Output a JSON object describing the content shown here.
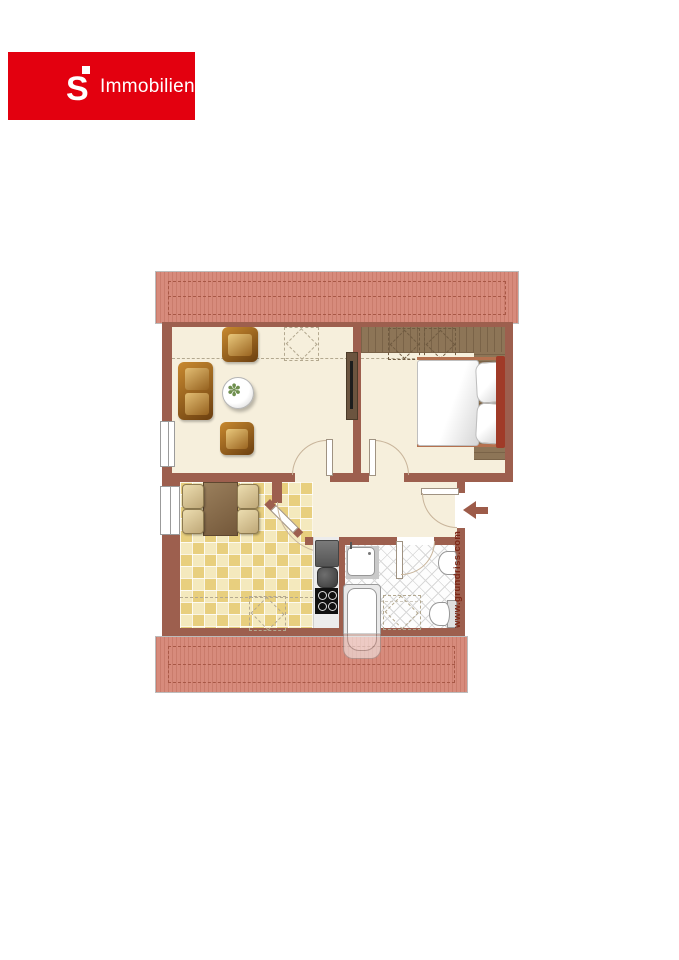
{
  "branding": {
    "logo_symbol": "S",
    "logo_text": "Immobilien",
    "logo_bg": "#e3000f",
    "logo_fg": "#ffffff"
  },
  "watermark": {
    "text": "www.grundriss.com",
    "color": "#7c2615"
  },
  "entrance": {
    "arrow_direction": "left"
  },
  "plan": {
    "type": "attic-apartment-floorplan",
    "rooms": [
      "living-room",
      "bedroom",
      "kitchen",
      "hallway",
      "bathroom"
    ],
    "furniture": {
      "living-room": [
        "sofa",
        "armchair",
        "armchair",
        "round-table-with-plant",
        "heater"
      ],
      "bedroom": [
        "wardrobe",
        "double-bed-with-pillows"
      ],
      "kitchen": [
        "dining-table",
        "chair",
        "chair",
        "chair",
        "chair",
        "fridge",
        "sink-pot",
        "cooktop"
      ],
      "bathroom": [
        "shower",
        "bathtub",
        "washbasin",
        "toilet"
      ]
    },
    "markers": [
      "roof-area-top",
      "roof-area-bottom",
      "dormer-window-dashed-squares",
      "knee-wall-dashed-lines",
      "entrance-arrow"
    ]
  },
  "palette": {
    "wall": "#9d5f4e",
    "floor": "#f6efdc",
    "roof": "#d78b7c",
    "roof_stripe": "#ca7c6c",
    "roof_dash": "#a85846",
    "tile_light": "#f4e9bd",
    "tile_dark": "#e8cf7e",
    "wood": "#8d7557",
    "wood_dark": "#7a6348",
    "leather_dark": "#6b3f10",
    "leather_light": "#c8892f",
    "logo_red": "#e3000f",
    "dash": "#b3a88f",
    "bath_line": "#d8d8d8",
    "accent_bed": "#a03b28",
    "text_wm": "#7c2615"
  }
}
